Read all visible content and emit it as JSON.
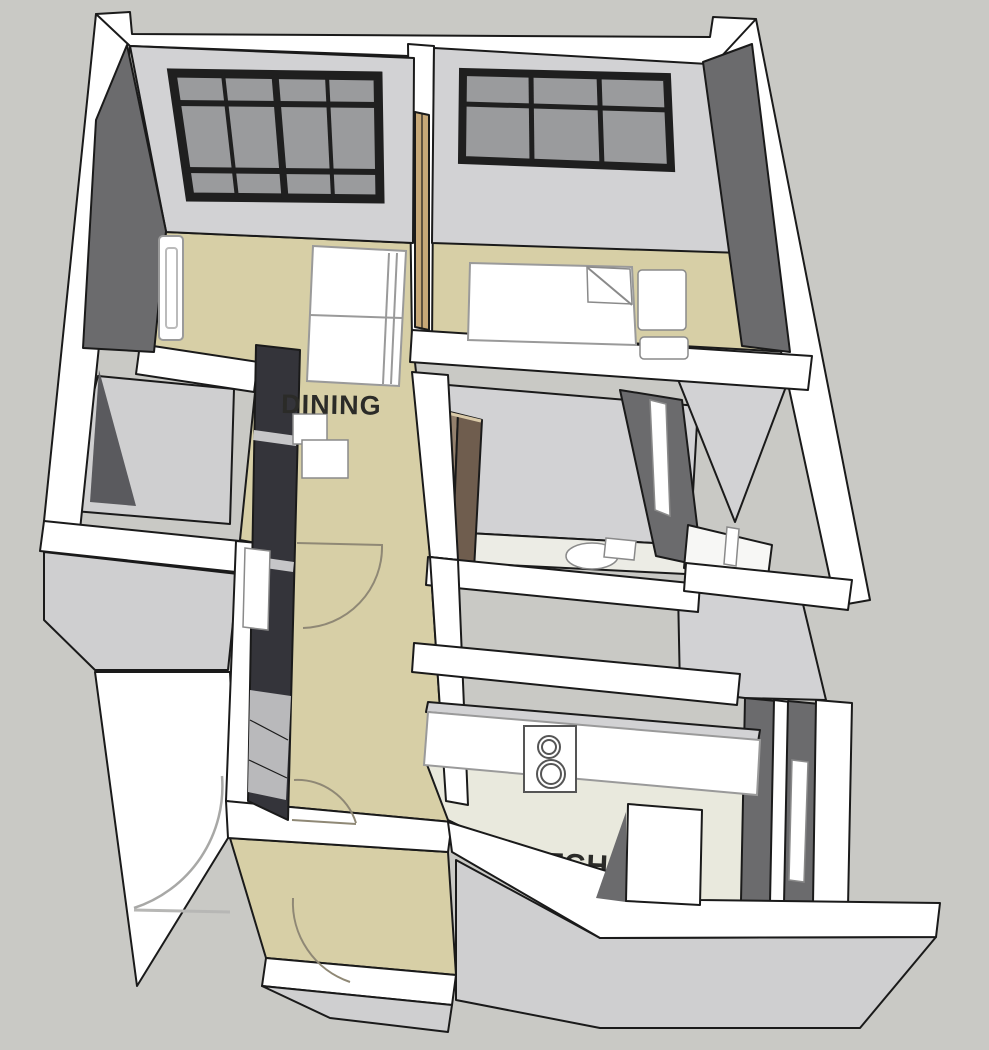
{
  "scene": {
    "type": "3d-floor-plan-render",
    "view": "axonometric-top",
    "style": "sketchup-monochrome-walls"
  },
  "labels": {
    "dining": "DINING",
    "kitchen": "KITCHEN"
  },
  "palette": {
    "background": "#c9c9c5",
    "wall_top": "#ffffff",
    "wall_face_light": "#d2d2d4",
    "wall_face_dark": "#6b6b6d",
    "wall_face_darker": "#5a5a5e",
    "outline": "#1a1a1a",
    "floor_hall_tan": "#d7cfa6",
    "floor_kitchen": "#e9e9dd",
    "floor_closet": "#cfcfd0",
    "floor_bath": "#ecece5",
    "window_frame": "#1f1f1f",
    "window_glass": "#9a9b9d",
    "door_panel_wood": "#c7a877",
    "cabinet_wood_light": "#93806d",
    "cabinet_wood_dark": "#6f5d4e",
    "wardrobe_dark": "#34343a",
    "furniture_white": "#ffffff",
    "arc_stroke": "#8f8875",
    "text_color": "#2b2b28"
  },
  "rooms": [
    {
      "name": "dining-living",
      "label": "DINING",
      "floor": "tan"
    },
    {
      "name": "bedroom",
      "label": "",
      "floor": "tan"
    },
    {
      "name": "closet",
      "label": "",
      "floor": "gray"
    },
    {
      "name": "bathroom",
      "label": "",
      "floor": "light"
    },
    {
      "name": "hallway",
      "label": "",
      "floor": "tan"
    },
    {
      "name": "kitchen",
      "label": "KITCHEN",
      "floor": "pale-green-gray"
    },
    {
      "name": "entry-vestibule",
      "label": "",
      "floor": "tan"
    }
  ],
  "windows": [
    {
      "location": "dining-north-wall",
      "columns": 4,
      "rows": 3
    },
    {
      "location": "bedroom-north-wall",
      "columns": 3,
      "rows": 2
    }
  ],
  "furniture": [
    "sofa",
    "coffee-boxes",
    "radiator-living",
    "bed",
    "pillow",
    "nightstand-upper",
    "nightstand-lower",
    "wardrobe-hall",
    "cabinet-bathroom",
    "toilet",
    "mirror-bathroom",
    "kitchen-counter",
    "stove-two-burners",
    "radiator-corridor",
    "radiator-balcony"
  ],
  "doors": [
    "hall-door-swing-arc",
    "mid-hall-door-swing-arc",
    "vestibule-door-swing-arc",
    "entry-door-swing-arc-exterior"
  ]
}
